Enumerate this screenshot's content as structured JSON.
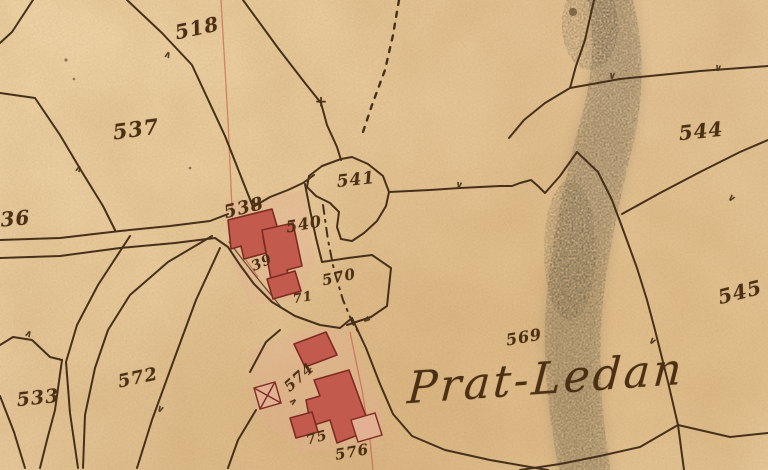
{
  "map": {
    "place_label": {
      "text": "Prat-Ledan",
      "x": 546,
      "y": 379,
      "rot": -4,
      "size": 44
    },
    "parcel_labels": [
      {
        "text": "518",
        "x": 197,
        "y": 28,
        "rot": -12,
        "size": 20
      },
      {
        "text": "537",
        "x": 136,
        "y": 129,
        "rot": -8,
        "size": 21
      },
      {
        "text": "536",
        "x": 8,
        "y": 219,
        "rot": -5,
        "size": 20
      },
      {
        "text": "538",
        "x": 244,
        "y": 208,
        "rot": -14,
        "size": 18
      },
      {
        "text": "540",
        "x": 304,
        "y": 224,
        "rot": -10,
        "size": 16
      },
      {
        "text": "541",
        "x": 356,
        "y": 180,
        "rot": -6,
        "size": 17
      },
      {
        "text": "39",
        "x": 262,
        "y": 263,
        "rot": -25,
        "size": 14
      },
      {
        "text": "570",
        "x": 339,
        "y": 277,
        "rot": -12,
        "size": 15
      },
      {
        "text": "71",
        "x": 303,
        "y": 298,
        "rot": -10,
        "size": 13
      },
      {
        "text": "544",
        "x": 701,
        "y": 131,
        "rot": -6,
        "size": 20
      },
      {
        "text": "545",
        "x": 740,
        "y": 292,
        "rot": -14,
        "size": 20
      },
      {
        "text": "569",
        "x": 524,
        "y": 337,
        "rot": -10,
        "size": 16
      },
      {
        "text": "572",
        "x": 138,
        "y": 378,
        "rot": -12,
        "size": 18
      },
      {
        "text": "533",
        "x": 38,
        "y": 398,
        "rot": -6,
        "size": 19
      },
      {
        "text": "574",
        "x": 299,
        "y": 377,
        "rot": -42,
        "size": 15
      },
      {
        "text": "75",
        "x": 317,
        "y": 438,
        "rot": -15,
        "size": 14
      },
      {
        "text": "576",
        "x": 352,
        "y": 452,
        "rot": -10,
        "size": 15
      }
    ],
    "boundary_ticks": [
      {
        "x": 168,
        "y": 54,
        "rot": 200
      },
      {
        "x": 79,
        "y": 168,
        "rot": 205
      },
      {
        "x": 29,
        "y": 333,
        "rot": 205
      },
      {
        "x": 160,
        "y": 410,
        "rot": 25
      },
      {
        "x": 459,
        "y": 186,
        "rot": 10
      },
      {
        "x": 612,
        "y": 77,
        "rot": 8
      },
      {
        "x": 718,
        "y": 69,
        "rot": 10
      },
      {
        "x": 731,
        "y": 199,
        "rot": 40
      },
      {
        "x": 652,
        "y": 342,
        "rot": 35
      },
      {
        "x": 366,
        "y": 320,
        "rot": 55
      },
      {
        "x": 294,
        "y": 401,
        "rot": 230
      }
    ],
    "tick_glyph": "∨",
    "junction_cross": {
      "x": 321,
      "y": 102,
      "glyph": "+"
    },
    "colors": {
      "parchment": "#e5c295",
      "ink": "#47301a",
      "label_ink": "#4c3014",
      "building_fill": "#c25b4e",
      "building_stroke": "#7e2c22",
      "wash": "#e2b093",
      "red_line": "#c04a3a",
      "smudge": "#57503f"
    }
  }
}
